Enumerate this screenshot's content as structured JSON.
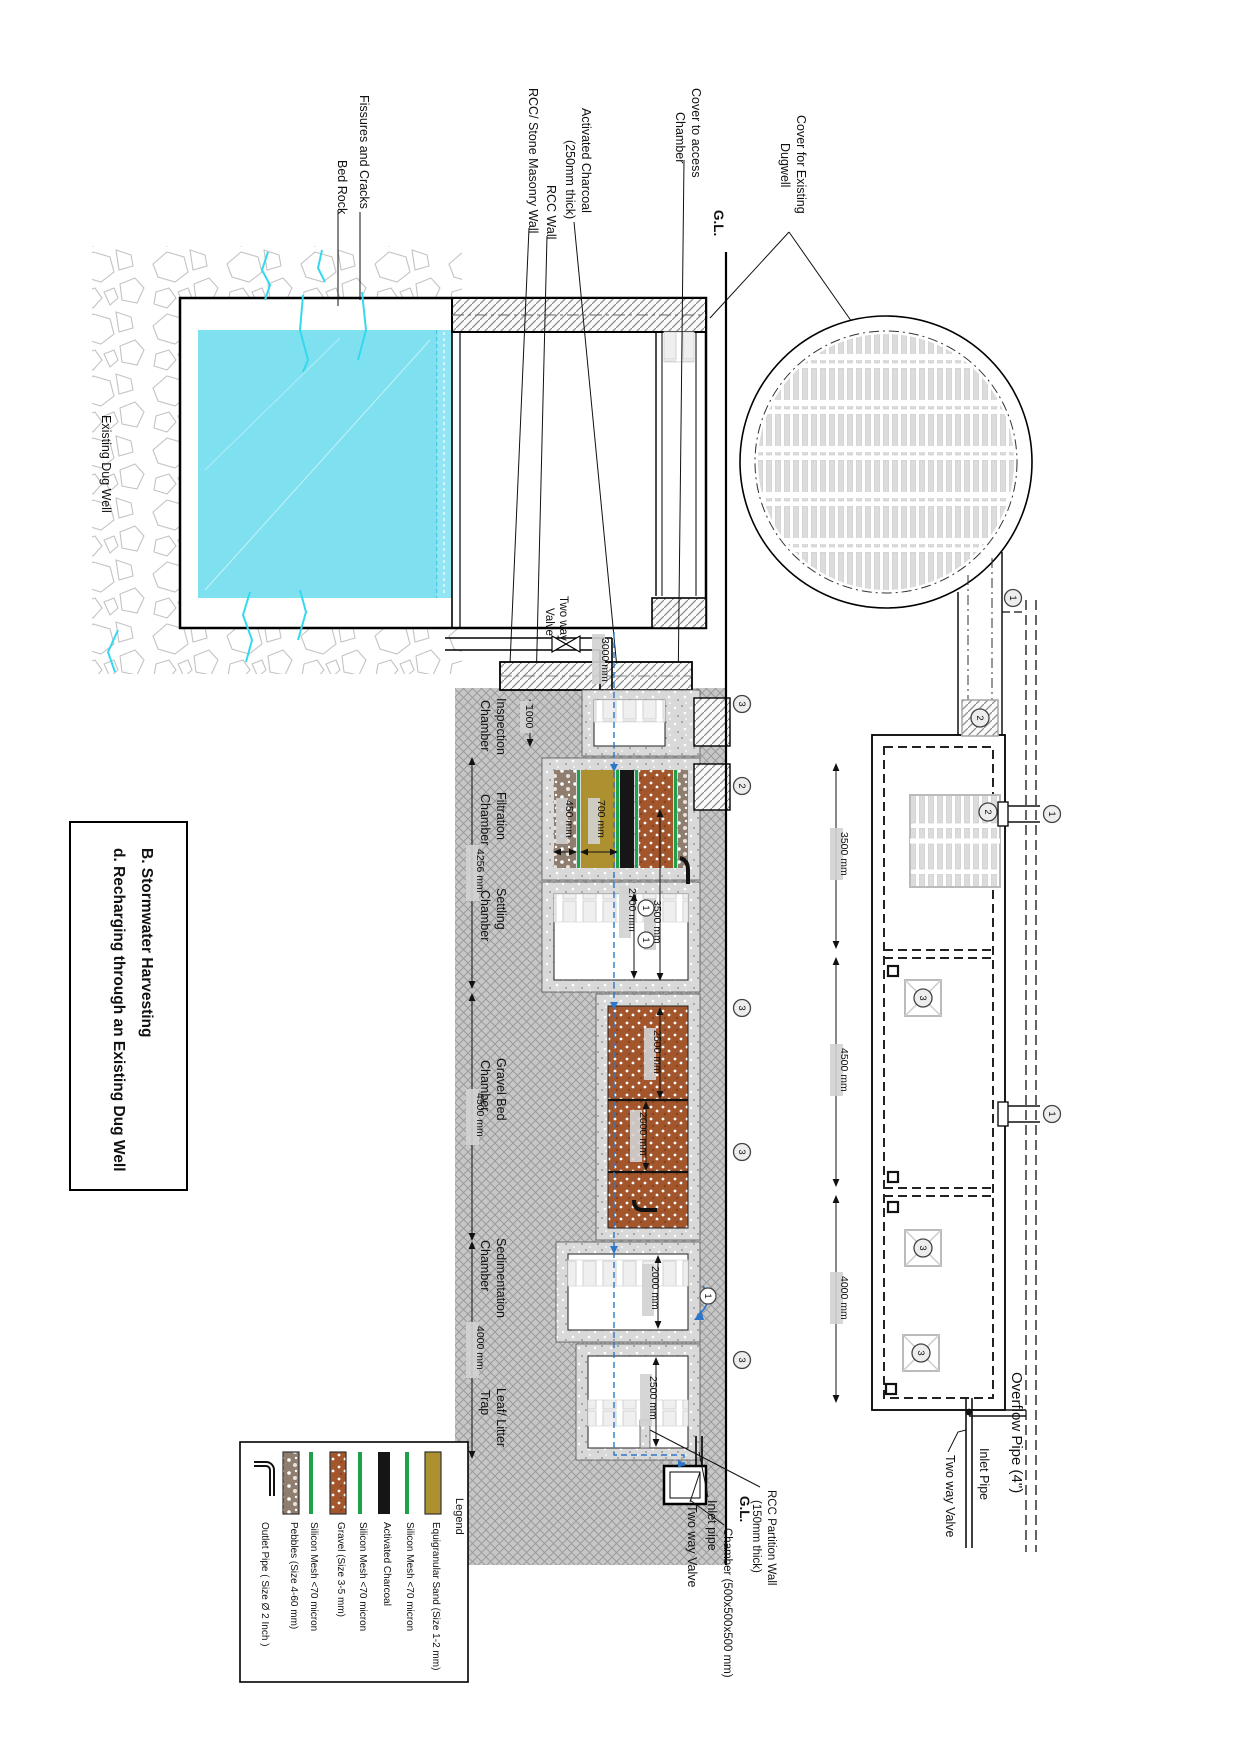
{
  "title": {
    "line1": "B. Stormwater Harvesting",
    "line2": "d.  Recharging through an Existing Dug Well"
  },
  "top_labels": {
    "fissures": "Fissures and Cracks",
    "bed_rock": "Bed Rock",
    "rcc_stone": "RCC/ Stone Masonry Wall",
    "rcc_wall": "RCC Wall",
    "charcoal_l1": "Activated Charcoal",
    "charcoal_l2": "(250mm thick)",
    "cover_access_l1": "Cover to access",
    "cover_access_l2": "Chamber",
    "gl": "G.L.",
    "cover_dugwell_l1": "Cover for Existing",
    "cover_dugwell_l2": "Dugwell"
  },
  "well": {
    "label": "Existing Dug Well"
  },
  "valve_top": {
    "l1": "Two way",
    "l2": "Valve"
  },
  "chambers": {
    "inspection1": "Inspection",
    "inspection2": "Chamber",
    "filtration1": "Filtration",
    "filtration2": "Chamber",
    "settling1": "Settling",
    "settling2": "Chamber",
    "gravel1": "Gravel Bed",
    "gravel2": "Chamber",
    "sediment1": "Sedimentation",
    "sediment2": "Chamber",
    "leaf1": "Leaf/ Litter",
    "leaf2": "Trap"
  },
  "dims": {
    "d1000": "1000",
    "d3000": "3000 mm",
    "d4256": "4256 mm",
    "d450": "450 mm",
    "d700": "700 mm",
    "d2700": "2700 mm",
    "d3500": "3500 mm",
    "d4500": "4500 mm",
    "d2500": "2500 mm",
    "d2000": "2000 mm",
    "d4000": "4000 mm",
    "sed2000": "2000 mm",
    "leaf2500": "2500 mm",
    "plan3500": "3500 mm",
    "plan4500": "4500 mm",
    "plan4000": "4000 mm"
  },
  "bottom_labels": {
    "two_way": "Two way Valve",
    "inlet_pipe": "Inlet pipe",
    "gl": "G.L.",
    "chamber_size": "Chamber (500x500x500 mm)",
    "partition_l1": "RCC Partition Wall",
    "partition_l2": "(150mm thick)"
  },
  "plan_labels": {
    "inlet": "Inlet Pipe",
    "two_way": "Two way Valve",
    "overflow": "Overflow Pipe (4\")"
  },
  "markers": {
    "m1": "1",
    "m2": "2",
    "m3": "3"
  },
  "legend": {
    "title": "Legend",
    "items": [
      {
        "name": "outlet-pipe",
        "label": "Outlet Pipe ( Size Ø 2 Inch )"
      },
      {
        "name": "pebbles",
        "label": "Pebbles (Size 4-60 mm)"
      },
      {
        "name": "silicon-mesh",
        "label": "Silicon Mesh <70 micron"
      },
      {
        "name": "gravel",
        "label": "Gravel (Size 3-5 mm)"
      },
      {
        "name": "silicon-mesh-2",
        "label": "Silicon Mesh <70 micron"
      },
      {
        "name": "activated-charcoal",
        "label": "Activated Charcoal"
      },
      {
        "name": "silicon-mesh-3",
        "label": "Silicon Mesh <70 micron"
      },
      {
        "name": "sand",
        "label": "Equigranular Sand (Size 1-2 mm)"
      }
    ]
  },
  "colors": {
    "water": "#7FE1F0",
    "sand": "#AD9030",
    "gravel": "#A3562B",
    "pebble": "#8F7E70",
    "mesh_green": "#1FA04A",
    "flow_blue": "#2E77C8"
  }
}
